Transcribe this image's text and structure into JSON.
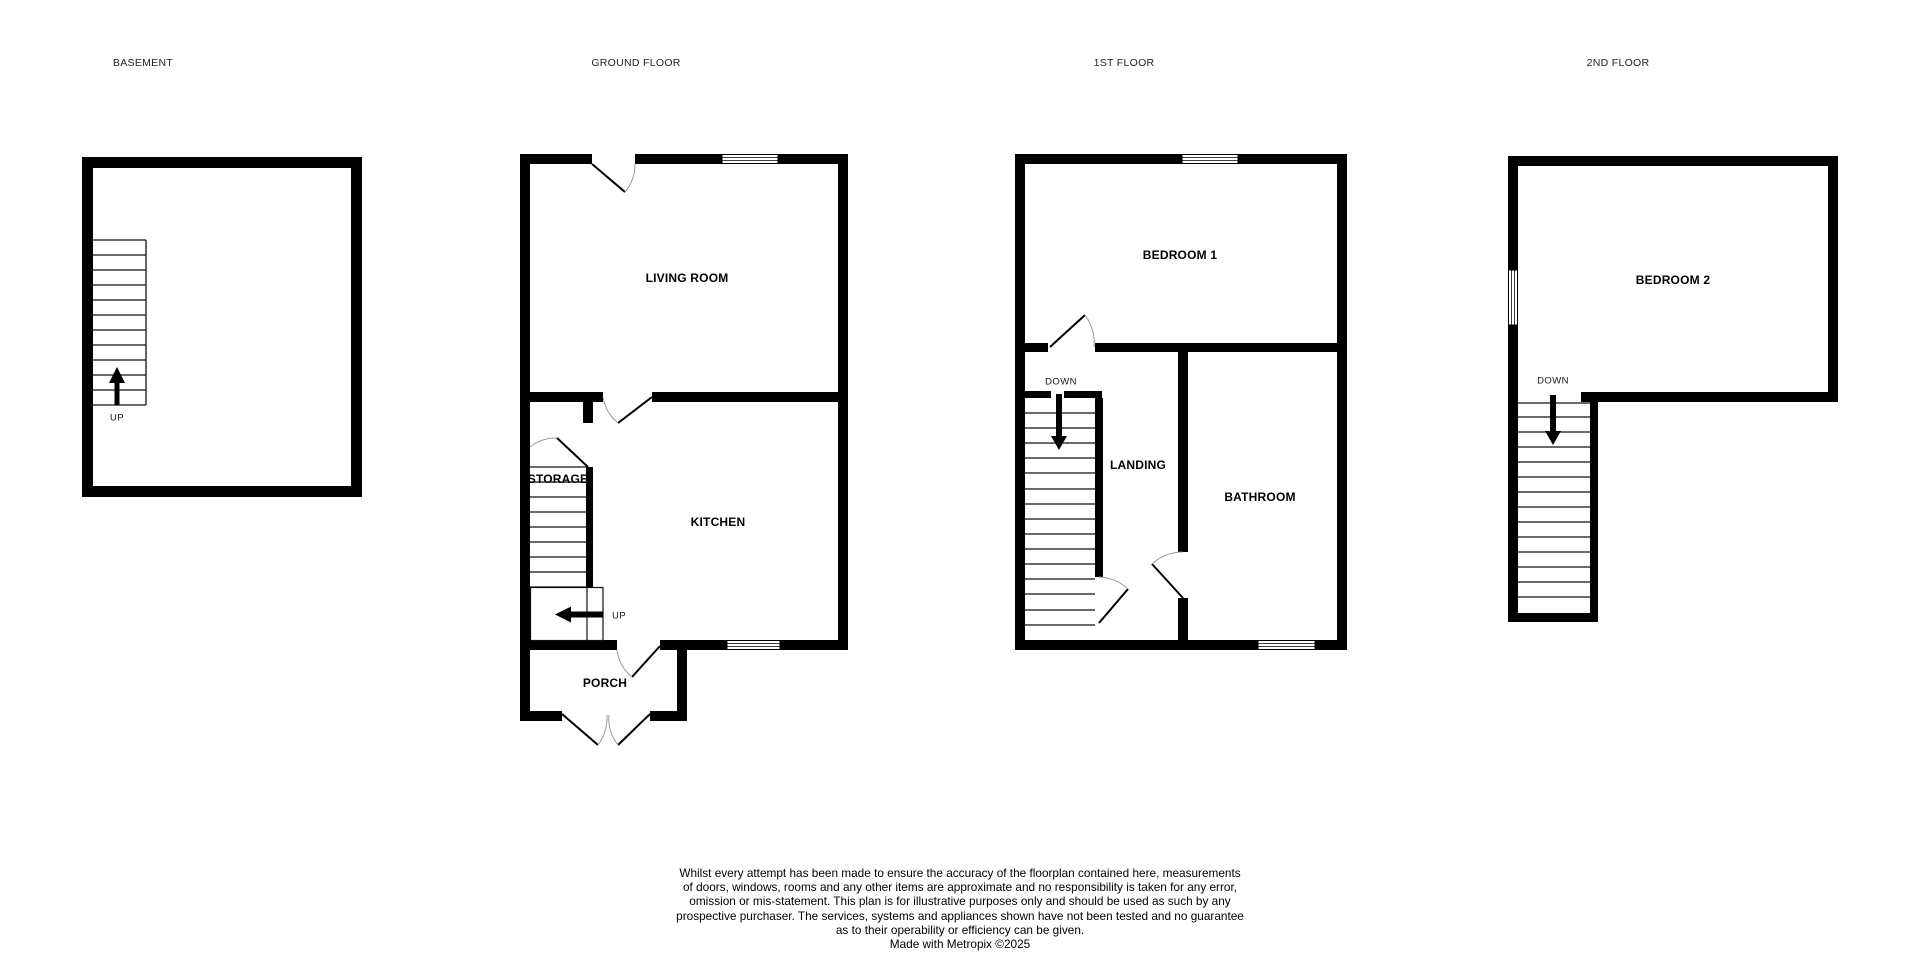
{
  "document": {
    "type": "floorplan",
    "credit": "Made with Metropix ©2025"
  },
  "colors": {
    "background": "#ffffff",
    "wall": "#000000",
    "door_arc": "#9a9a9a",
    "text": "#000000"
  },
  "floors": [
    {
      "id": "basement",
      "title": "BASEMENT",
      "rooms": [],
      "stair_direction": "UP"
    },
    {
      "id": "ground",
      "title": "GROUND FLOOR",
      "rooms": [
        "LIVING ROOM",
        "STORAGE",
        "KITCHEN",
        "PORCH"
      ],
      "stair_direction": "UP"
    },
    {
      "id": "first",
      "title": "1ST FLOOR",
      "rooms": [
        "BEDROOM 1",
        "LANDING",
        "BATHROOM"
      ],
      "stair_direction": "DOWN"
    },
    {
      "id": "second",
      "title": "2ND FLOOR",
      "rooms": [
        "BEDROOM 2"
      ],
      "stair_direction": "DOWN"
    }
  ],
  "disclaimer": {
    "lines": [
      "Whilst every attempt has been made to ensure the accuracy of the floorplan contained here, measurements",
      "of doors, windows, rooms and any other items are approximate and no responsibility is taken for any error,",
      "omission or mis-statement. This plan is for illustrative purposes only and should be used as such by any",
      "prospective purchaser. The services, systems and appliances shown have not been tested and no guarantee",
      "as to their operability or efficiency can be given.",
      "Made with Metropix ©2025"
    ]
  }
}
